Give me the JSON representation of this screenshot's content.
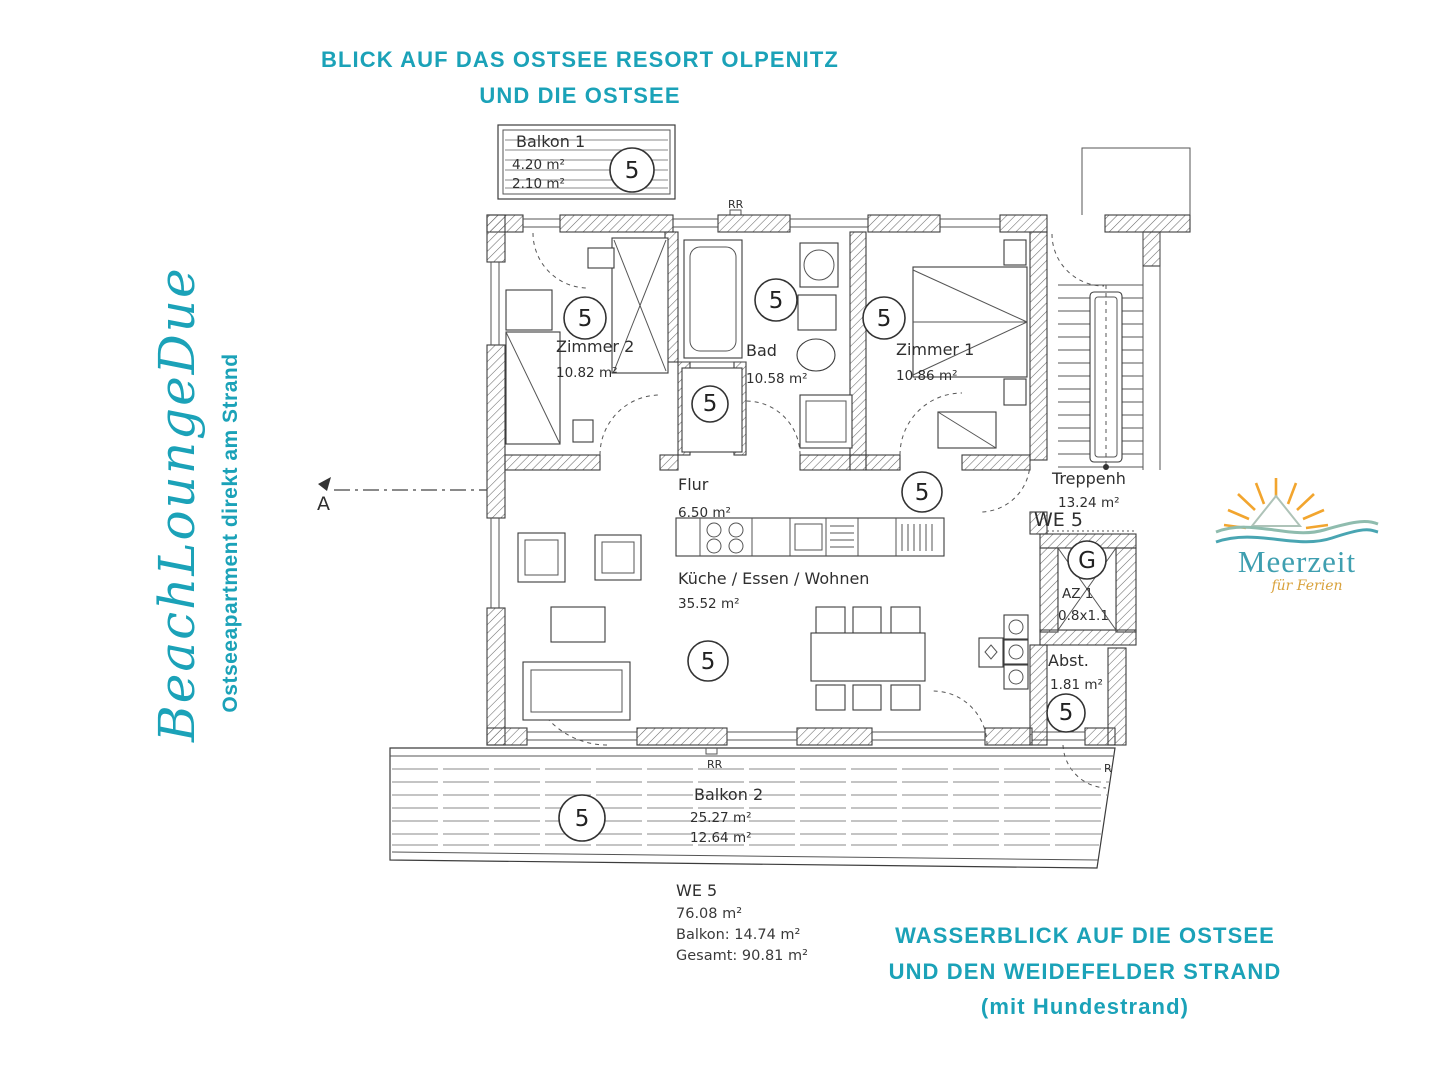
{
  "colors": {
    "accent": "#1BA2B8",
    "logo_teal": "#3F9FB0",
    "logo_sun": "#F2A52E",
    "logo_gold": "#D9A23C",
    "plan_ink": "#3C3C3C"
  },
  "captions": {
    "top": {
      "line1": "BLICK AUF DAS OSTSEE RESORT OLPENITZ",
      "line2": "UND DIE OSTSEE"
    },
    "bottom": {
      "line1": "WASSERBLICK AUF DIE OSTSEE",
      "line2": "UND DEN WEIDEFELDER STRAND",
      "line3": "(mit Hundestrand)"
    }
  },
  "brand": {
    "script_name": "BeachLoungeDue",
    "tagline": "Ostseeapartment direkt am Strand"
  },
  "logo": {
    "name": "Meerzeit",
    "subtitle": "für Ferien"
  },
  "plan": {
    "unit_number": "5",
    "entry_unit_label": "WE 5",
    "rr_label": "RR",
    "r_label": "R",
    "garderobe_letter": "G",
    "section_marker": "A",
    "rooms": {
      "balkon1": {
        "name": "Balkon 1",
        "area_a": "4.20 m²",
        "area_b": "2.10 m²"
      },
      "zimmer2": {
        "name": "Zimmer 2",
        "area": "10.82 m²"
      },
      "bad": {
        "name": "Bad",
        "area": "10.58 m²"
      },
      "zimmer1": {
        "name": "Zimmer 1",
        "area": "10.86 m²"
      },
      "flur": {
        "name": "Flur",
        "area": "6.50 m²"
      },
      "treppenhaus": {
        "name": "Treppenh",
        "area": "13.24 m²"
      },
      "kueche": {
        "name": "Küche / Essen / Wohnen",
        "area": "35.52 m²"
      },
      "az1": {
        "name": "AZ 1",
        "size": "0.8x1.1"
      },
      "abst": {
        "name": "Abst.",
        "area": "1.81 m²"
      },
      "balkon2": {
        "name": "Balkon 2",
        "area_a": "25.27 m²",
        "area_b": "12.64 m²"
      }
    },
    "summary": {
      "title": "WE 5",
      "area": "76.08 m²",
      "balkon": "Balkon: 14.74 m²",
      "gesamt": "Gesamt: 90.81 m²"
    }
  }
}
